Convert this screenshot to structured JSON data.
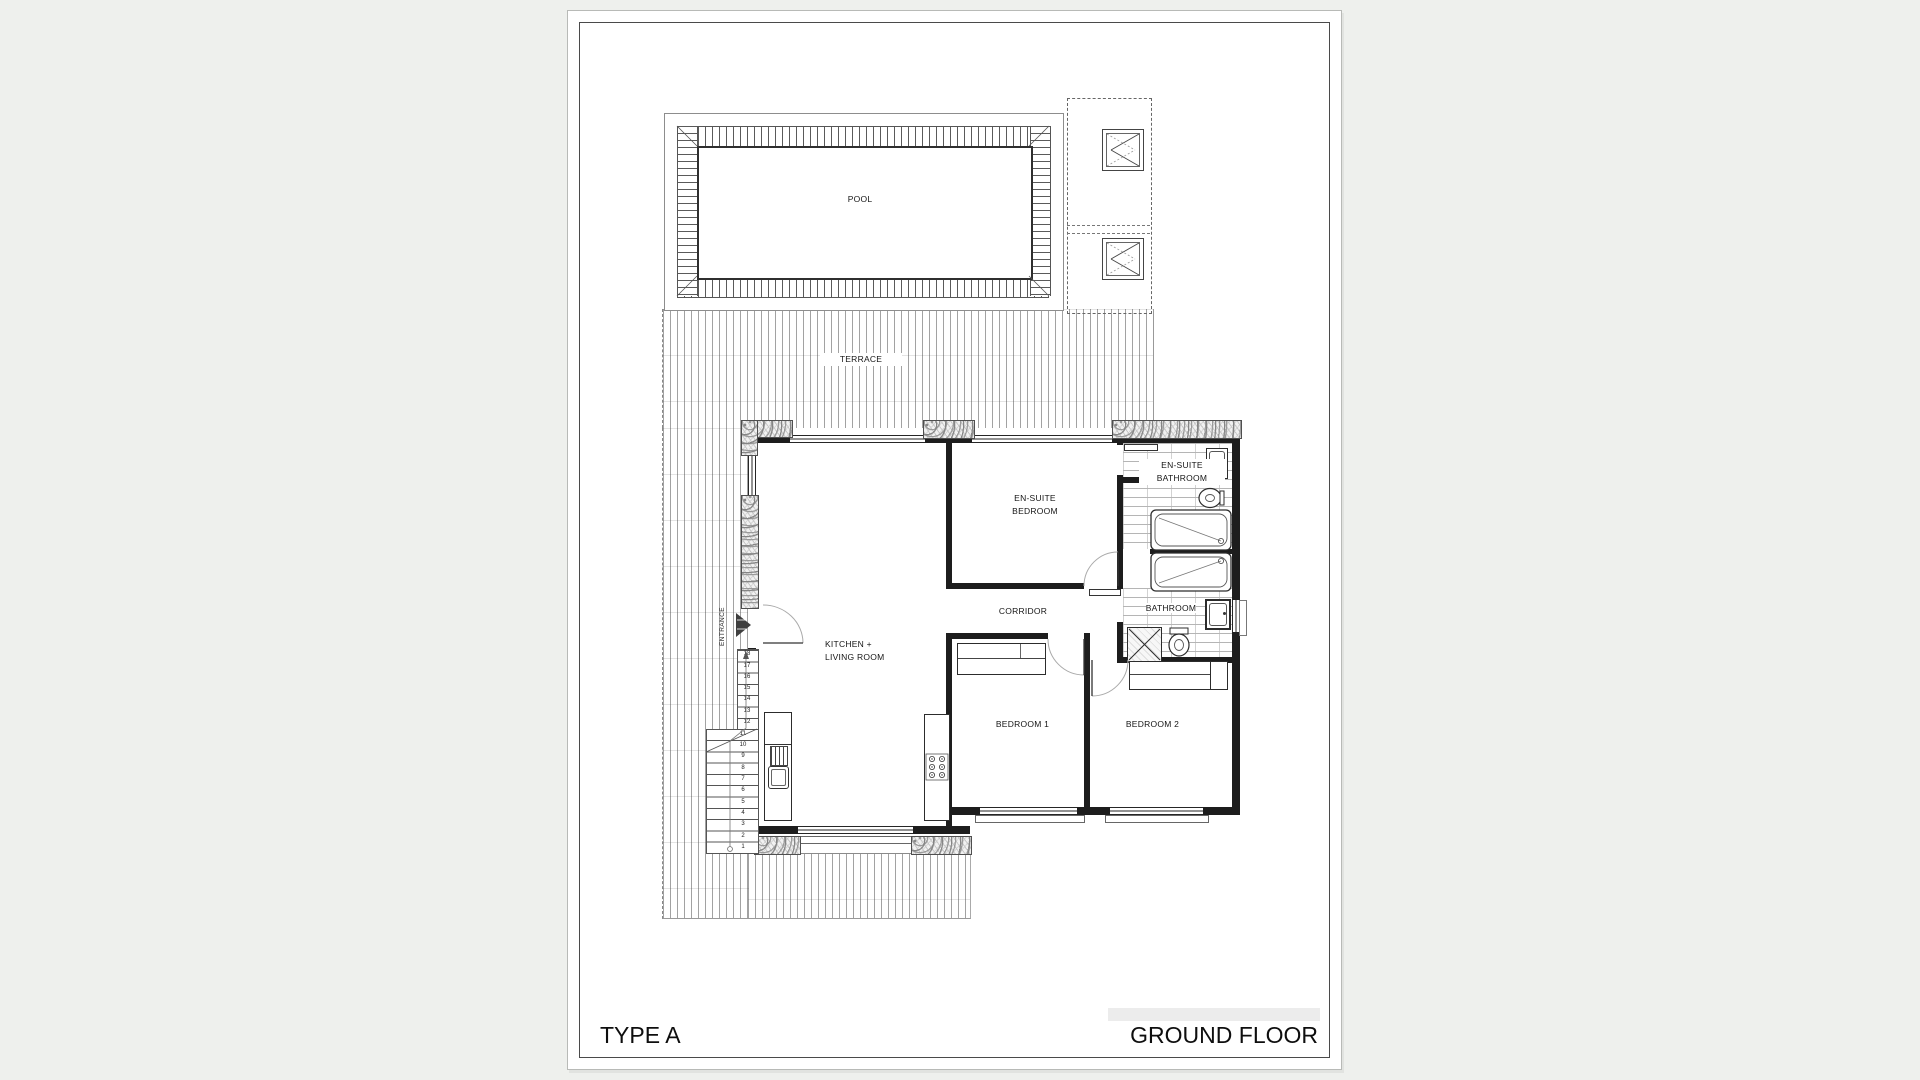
{
  "colors": {
    "canvas_background": "#eef0ed",
    "paper": "#ffffff",
    "line": "#1d1d1d",
    "hatch_gray": "#8a8a8a"
  },
  "title_block": {
    "type_label": "TYPE A",
    "floor_label": "GROUND FLOOR"
  },
  "rooms": {
    "pool": "POOL",
    "terrace": "TERRACE",
    "ensuite_bedroom": [
      "EN-SUITE",
      "BEDROOM"
    ],
    "ensuite_bathroom": [
      "EN-SUITE",
      "BATHROOM"
    ],
    "corridor": "CORRIDOR",
    "kitchen_living": [
      "KITCHEN +",
      "LIVING ROOM"
    ],
    "bathroom": "BATHROOM",
    "bedroom1": "BEDROOM 1",
    "bedroom2": "BEDROOM 2"
  },
  "stairs": {
    "entrance_label": "ENTRANCE",
    "numbers": [
      "1",
      "2",
      "3",
      "4",
      "5",
      "6",
      "7",
      "8",
      "9",
      "10",
      "11",
      "12",
      "13",
      "14",
      "15",
      "16",
      "17",
      "18"
    ]
  }
}
